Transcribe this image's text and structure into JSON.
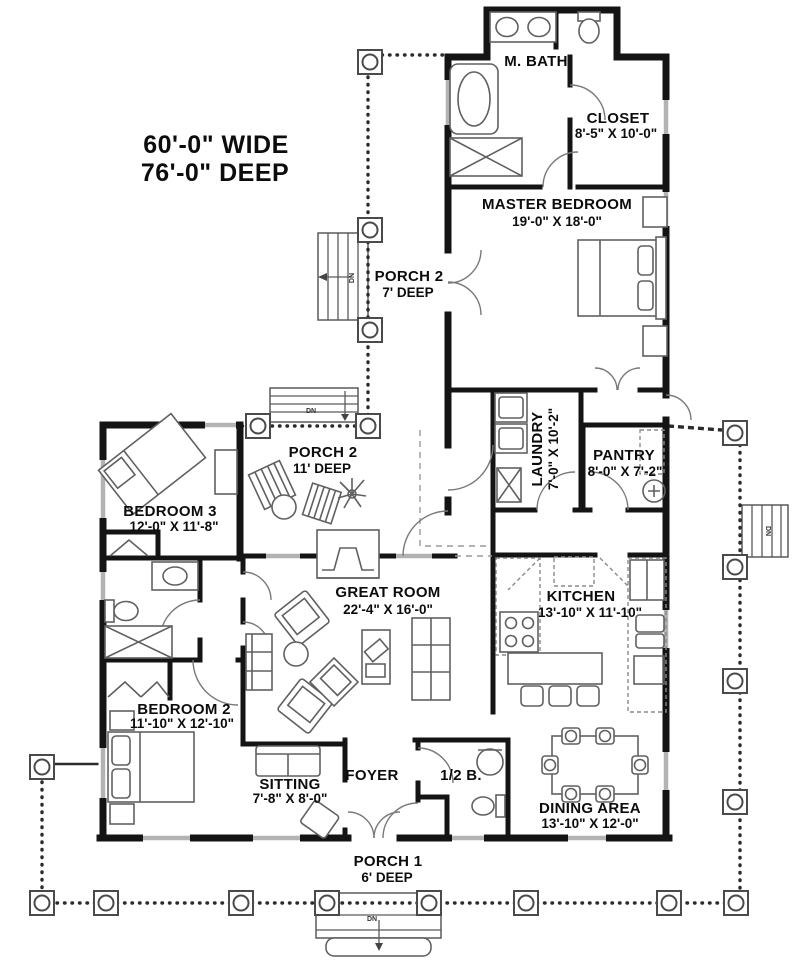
{
  "plan": {
    "overall": {
      "width_label": "60'-0\" WIDE",
      "depth_label": "76'-0\" DEEP"
    },
    "rooms": {
      "m_bath": {
        "name": "M. BATH"
      },
      "closet": {
        "name": "CLOSET",
        "dims": "8'-5\" X 10'-0\""
      },
      "master_bedroom": {
        "name": "MASTER BEDROOM",
        "dims": "19'-0\" X 18'-0\""
      },
      "porch2_rear": {
        "name": "PORCH 2",
        "dims": "7' DEEP"
      },
      "porch2_side": {
        "name": "PORCH 2",
        "dims": "11' DEEP"
      },
      "laundry": {
        "name": "LAUNDRY",
        "dims": "7'-0\" X 10'-2\""
      },
      "pantry": {
        "name": "PANTRY",
        "dims": "8'-0\" X 7'-2\""
      },
      "bedroom3": {
        "name": "BEDROOM 3",
        "dims": "12'-0\" X 11'-8\""
      },
      "great_room": {
        "name": "GREAT ROOM",
        "dims": "22'-4\" X 16'-0\""
      },
      "kitchen": {
        "name": "KITCHEN",
        "dims": "13'-10\" X 11'-10\""
      },
      "bedroom2": {
        "name": "BEDROOM 2",
        "dims": "11'-10\" X 12'-10\""
      },
      "sitting": {
        "name": "SITTING",
        "dims": "7'-8\" X 8'-0\""
      },
      "foyer": {
        "name": "FOYER"
      },
      "half_bath": {
        "name": "1/2 B."
      },
      "dining": {
        "name": "DINING AREA",
        "dims": "13'-10\" X 12'-0\""
      },
      "porch1": {
        "name": "PORCH 1",
        "dims": "6' DEEP"
      }
    },
    "annotations": {
      "down": "DN"
    },
    "colors": {
      "wall": "#141414",
      "fixture": "#606060",
      "window": "#b3b3b3",
      "porch_edge": "#2b2b2b",
      "background": "#ffffff"
    }
  }
}
